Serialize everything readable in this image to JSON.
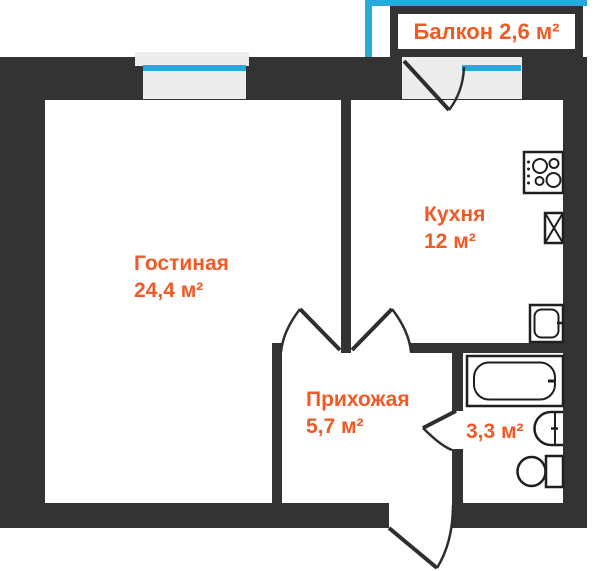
{
  "plan_title": "apartment-floor-plan",
  "colors": {
    "wall": "#333333",
    "label_orange": "#f15a24",
    "window_blue": "#29a8dc",
    "window_fill": "#ededed",
    "fixture_outline": "#2b2b2b",
    "fixture_fill": "#ffffff"
  },
  "rooms": {
    "balcony": {
      "label": "Балкон 2,6 м²"
    },
    "living": {
      "name": "Гостиная",
      "area": "24,4 м²"
    },
    "kitchen": {
      "name": "Кухня",
      "area": "12 м²"
    },
    "hallway": {
      "name": "Прихожая",
      "area": "5,7 м²"
    },
    "bathroom": {
      "area": "3,3 м²"
    }
  },
  "fixtures": {
    "stove": "stove-icon",
    "vent_shaft": "vent-shaft-icon",
    "appliance": "appliance-icon",
    "bathtub": "bathtub-icon",
    "sink": "sink-icon",
    "toilet": "toilet-icon"
  },
  "doors": [
    "balcony-door",
    "living-room-door",
    "kitchen-door",
    "bathroom-door",
    "entrance-door"
  ],
  "windows": [
    "living-room-window",
    "kitchen-window",
    "balcony-glazing"
  ]
}
